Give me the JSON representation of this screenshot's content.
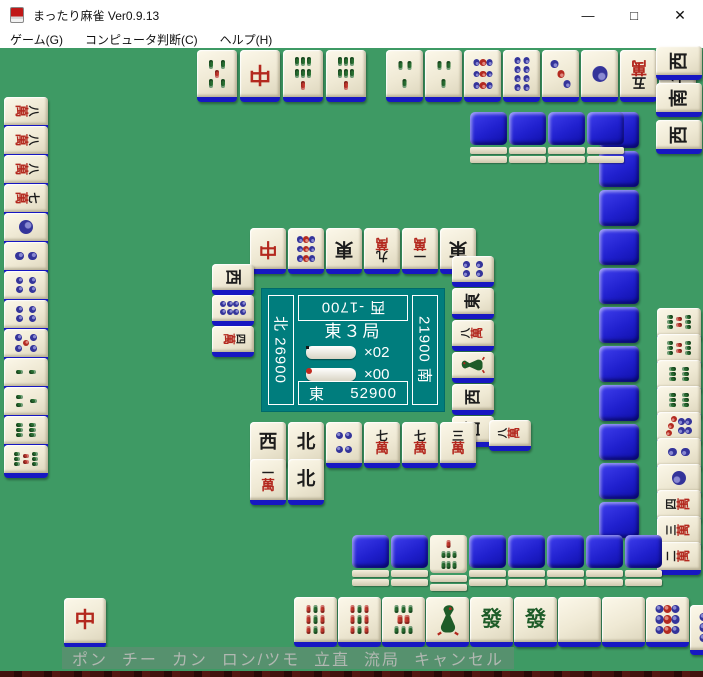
{
  "window": {
    "title": "まったり麻雀 Ver0.9.13",
    "minimize": "—",
    "maximize": "□",
    "close": "✕"
  },
  "menu": {
    "items": [
      "ゲーム(G)",
      "コンピュータ判断(C)",
      "ヘルプ(H)"
    ]
  },
  "panel": {
    "round": "東３局",
    "honba_label": "×02",
    "riichi_label": "×00",
    "north_label": "北 26900",
    "west_label": "西 -1700",
    "south_label": "21900 南",
    "east_seat": "東",
    "east_score": "52900"
  },
  "actions": [
    "ポン",
    "チー",
    "カン",
    "ロン/ツモ",
    "立直",
    "流局",
    "キャンセル"
  ],
  "tile_legend": {
    "m1": "一萬",
    "m2": "二萬",
    "m3": "三萬",
    "m4": "四萬",
    "m5": "五萬",
    "m7": "七萬",
    "m8": "八萬",
    "m9": "九萬",
    "p1": "一筒",
    "p2": "二筒",
    "p3": "三筒",
    "p4": "四筒",
    "p5": "五筒",
    "p7": "七筒",
    "p8": "八筒",
    "p9": "九筒",
    "s1": "一索",
    "s2": "二索",
    "s3": "三索",
    "s5": "五索",
    "s6": "六索",
    "s7": "七索",
    "s8": "八索",
    "s9": "九索",
    "east": "東",
    "south": "南",
    "west": "西",
    "north": "北",
    "haku": "白",
    "hatsu": "發",
    "chun": "中",
    "back": "裏"
  },
  "groups": [
    {
      "name": "top-hand-left",
      "orient": "down",
      "x": 197,
      "y": 2,
      "dx": 43,
      "dy": 0,
      "w": 40,
      "h": 52,
      "faces": [
        "s5",
        "chun",
        "s7",
        "s7"
      ]
    },
    {
      "name": "top-hand-right",
      "orient": "down",
      "x": 386,
      "y": 2,
      "dx": 39,
      "dy": 0,
      "w": 37,
      "h": 52,
      "faces": [
        "s3",
        "s3",
        "p9",
        "p8",
        "p3",
        "p1",
        "m5",
        "m7"
      ]
    },
    {
      "name": "right-meld",
      "orient": "left",
      "x": 656,
      "y": -2,
      "dx": 0,
      "dy": 37,
      "w": 46,
      "h": 34,
      "faces": [
        "west",
        "south",
        "west"
      ]
    },
    {
      "name": "right-wall",
      "type": "back",
      "x": 599,
      "y": 64,
      "dx": 0,
      "dy": 39,
      "w": 40,
      "h": 36,
      "faces": [
        "back",
        "back",
        "back",
        "back",
        "back",
        "back",
        "back",
        "back",
        "back",
        "back",
        "back"
      ]
    },
    {
      "name": "top-wall",
      "type": "stack",
      "x": 470,
      "y": 64,
      "dx": 39,
      "dy": 0,
      "w": 37,
      "h": 54,
      "faces": [
        "back",
        "back",
        "back",
        "back"
      ]
    },
    {
      "name": "left-hand",
      "orient": "right",
      "x": 4,
      "y": 49,
      "dx": 0,
      "dy": 29,
      "w": 44,
      "h": 33,
      "faces": [
        "m8",
        "m8",
        "m8",
        "m7",
        "p1",
        "p2",
        "p4",
        "p4",
        "p5",
        "s2",
        "s3",
        "s6",
        "s8"
      ]
    },
    {
      "name": "top-discards",
      "orient": "down",
      "x": 250,
      "y": 180,
      "dx": 38,
      "dy": 0,
      "w": 36,
      "h": 46,
      "faces": [
        "chun",
        "p9",
        "east",
        "m9",
        "m1",
        "east"
      ]
    },
    {
      "name": "left-discards",
      "orient": "right",
      "x": 212,
      "y": 216,
      "dx": 0,
      "dy": 31,
      "w": 42,
      "h": 31,
      "faces": [
        "west",
        "p8",
        "m4"
      ]
    },
    {
      "name": "right-discards",
      "orient": "left",
      "x": 452,
      "y": 208,
      "dx": 0,
      "dy": 32,
      "w": 42,
      "h": 31,
      "faces": [
        "p4",
        "east",
        "m8",
        "s1",
        "west",
        "west"
      ]
    },
    {
      "name": "right-riichi",
      "orient": "left",
      "x": 489,
      "y": 372,
      "dx": 0,
      "dy": 0,
      "w": 42,
      "h": 31,
      "faces": [
        "m8"
      ]
    },
    {
      "name": "right-hand",
      "orient": "left",
      "x": 657,
      "y": 260,
      "dx": 0,
      "dy": 26,
      "w": 44,
      "h": 33,
      "faces": [
        "s8",
        "s8",
        "s6",
        "s6",
        "p7",
        "p2",
        "p1",
        "m4",
        "m3",
        "m2"
      ]
    },
    {
      "name": "bottom-discards-1",
      "orient": "up",
      "x": 250,
      "y": 374,
      "dx": 38,
      "dy": 0,
      "w": 36,
      "h": 46,
      "faces": [
        "west",
        "north",
        "p4",
        "m7",
        "m7",
        "m3"
      ]
    },
    {
      "name": "bottom-discards-2",
      "orient": "up",
      "x": 250,
      "y": 411,
      "dx": 38,
      "dy": 0,
      "w": 36,
      "h": 46,
      "faces": [
        "m1",
        "north"
      ]
    },
    {
      "name": "bottom-wall",
      "type": "stack",
      "x": 352,
      "y": 487,
      "dx": 39,
      "dy": 0,
      "w": 37,
      "h": 54,
      "faces": [
        "back",
        "back",
        "s7",
        "back",
        "back",
        "back",
        "back",
        "back"
      ]
    },
    {
      "name": "hand-called",
      "orient": "up",
      "x": 64,
      "y": 550,
      "dx": 0,
      "dy": 0,
      "w": 42,
      "h": 50,
      "faces": [
        "chun"
      ],
      "interactable": true
    },
    {
      "name": "player-hand",
      "orient": "up",
      "x": 294,
      "y": 549,
      "dx": 44,
      "dy": 0,
      "w": 43,
      "h": 50,
      "faces": [
        "s9",
        "s9",
        "s8",
        "s1",
        "hatsu",
        "hatsu",
        "haku",
        "haku",
        "p9"
      ],
      "interactable": true
    },
    {
      "name": "player-draw",
      "orient": "up",
      "x": 690,
      "y": 557,
      "dx": 0,
      "dy": 0,
      "w": 43,
      "h": 50,
      "faces": [
        "p9"
      ],
      "interactable": true
    }
  ]
}
